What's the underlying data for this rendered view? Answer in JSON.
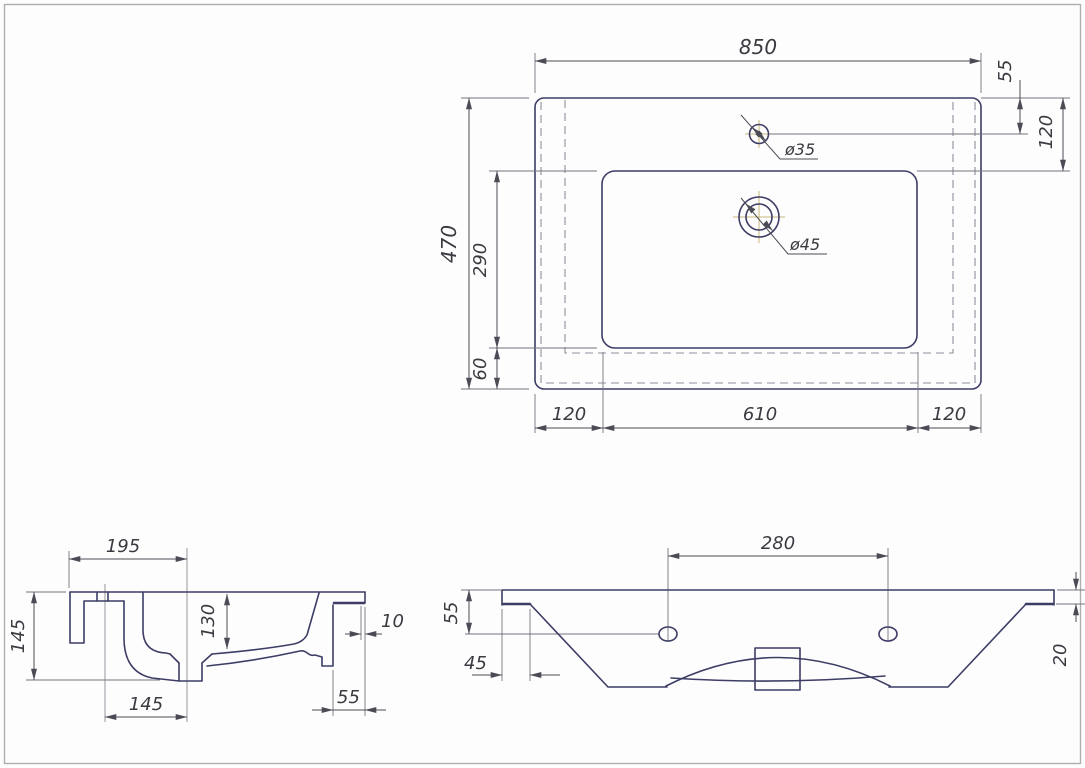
{
  "drawing": {
    "type": "technical-drawing-washbasin",
    "colors": {
      "outline": "#3d3d66",
      "dimension": "#4b4b55",
      "hidden_line": "#8e8e9e",
      "centerline_cross": "#c9b87c",
      "frame": "#aeaeae",
      "background": "#fdfdfd"
    },
    "top_view": {
      "dims": {
        "overall_width": "850",
        "overall_depth": "470",
        "basin_depth": "290",
        "bottom_offset": "60",
        "faucet_center_offset": "55",
        "basin_top_offset": "120",
        "margin_left": "120",
        "basin_width": "610",
        "margin_right": "120",
        "faucet_hole_dia": "ø35",
        "drain_hole_dia": "ø45"
      }
    },
    "side_view": {
      "dims": {
        "drain_from_back": "195",
        "overall_height": "145",
        "bowl_depth": "130",
        "lip_thickness": "10",
        "drain_from_faucet": "145",
        "front_overhang": "55"
      }
    },
    "front_view": {
      "dims": {
        "hole_spacing": "280",
        "hole_depth_offset": "55",
        "edge_inset": "45",
        "edge_thickness": "20"
      }
    }
  }
}
